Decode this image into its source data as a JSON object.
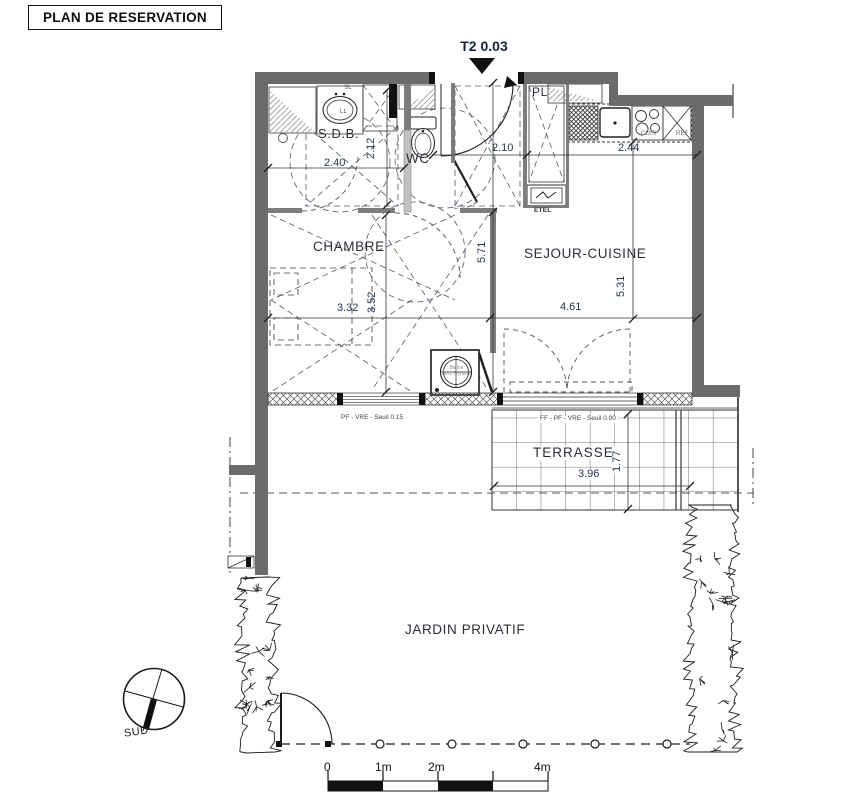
{
  "title": "PLAN DE RESERVATION",
  "unit": {
    "label": "T2 0.03"
  },
  "rooms": {
    "sdb": "S.D.B.",
    "wc": "WC",
    "pl": "PL",
    "chambre": "CHAMBRE",
    "sejour": "SEJOUR-CUISINE",
    "terrasse": "TERRASSE",
    "jardin": "JARDIN PRIVATIF"
  },
  "dims": {
    "sdb_w": "2.40",
    "sdb_d": "2.12",
    "entry": "2.10",
    "kitchen": "2.44",
    "depth": "5.71",
    "sejour_d": "5.31",
    "chambre_w": "3.32",
    "chambre_d": "3.52",
    "sejour_w": "4.61",
    "terrasse_w": "3.96",
    "terrasse_d": "1.77"
  },
  "annotations": {
    "etel": "ETEL",
    "cuis": "CUIS",
    "ref": "REF",
    "sl": "SL",
    "ll": "LL",
    "ballon_1": "Ballon",
    "ballon_2": "Aéro Dynam.",
    "seuil_chambre": "PF - VRE - Seuil 0.15",
    "seuil_sejour": "FF - PF - VRE - Seuil 0.00"
  },
  "compass": {
    "south": "SUD"
  },
  "scale": {
    "t0": "0",
    "t1": "1m",
    "t2": "2m",
    "t4": "4m"
  },
  "colors": {
    "wall": "#6b6b6b",
    "line": "#333333",
    "dim_text": "#1d3350"
  }
}
